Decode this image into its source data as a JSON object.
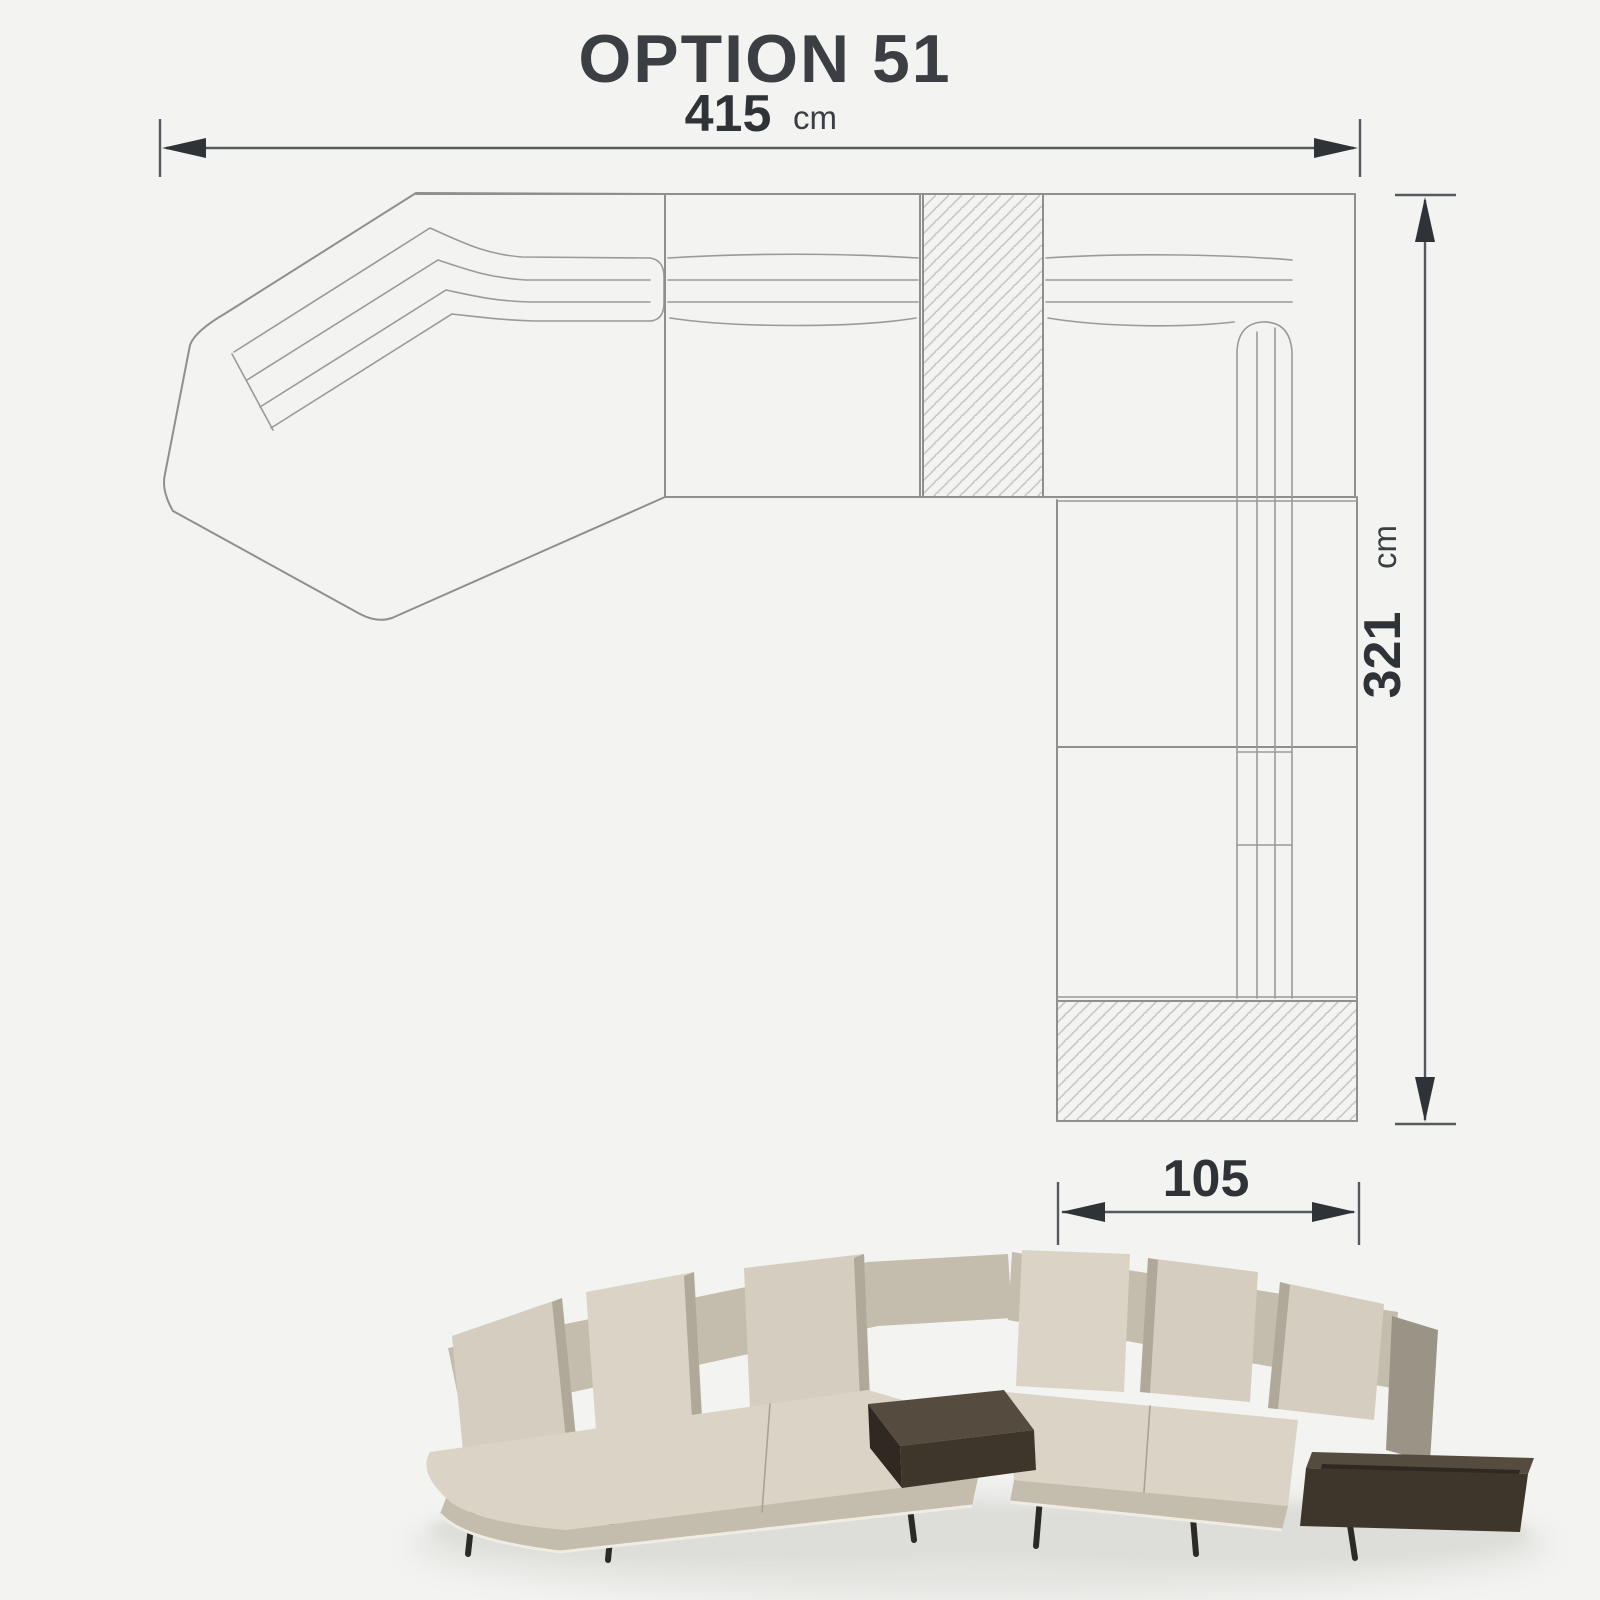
{
  "page": {
    "background_color": "#f3f3f1"
  },
  "plan": {
    "title": "OPTION 51",
    "width_dimension": {
      "value": "415",
      "unit": "cm"
    },
    "height_dimension": {
      "value": "321",
      "unit": "cm"
    },
    "depth_dimension": {
      "value": "105"
    },
    "modules": {
      "left": "angled-chaise-module",
      "middle": "straight-seat-module",
      "middle_hatch": "tray-table-element",
      "corner": "corner-seat-module",
      "right_column": "right-seat-module",
      "bottom_hatch": "end-table-element"
    },
    "colors": {
      "outline": "#8f8f8d",
      "hatch": "#c6c6c4",
      "dimension_line": "#55585c",
      "dimension_text": "#2f3338",
      "title_text": "#3b3f44"
    }
  },
  "photo": {
    "subject": "beige-sectional-sofa-with-corner-and-end-tray-tables",
    "colors": {
      "fabric": "#d5cec0",
      "fabric_shadow": "#b0a999",
      "table_top": "#554c3f",
      "table_front": "#3e362b",
      "legs": "#2c2a26",
      "floor_shadow": "#e3e3e0"
    }
  }
}
